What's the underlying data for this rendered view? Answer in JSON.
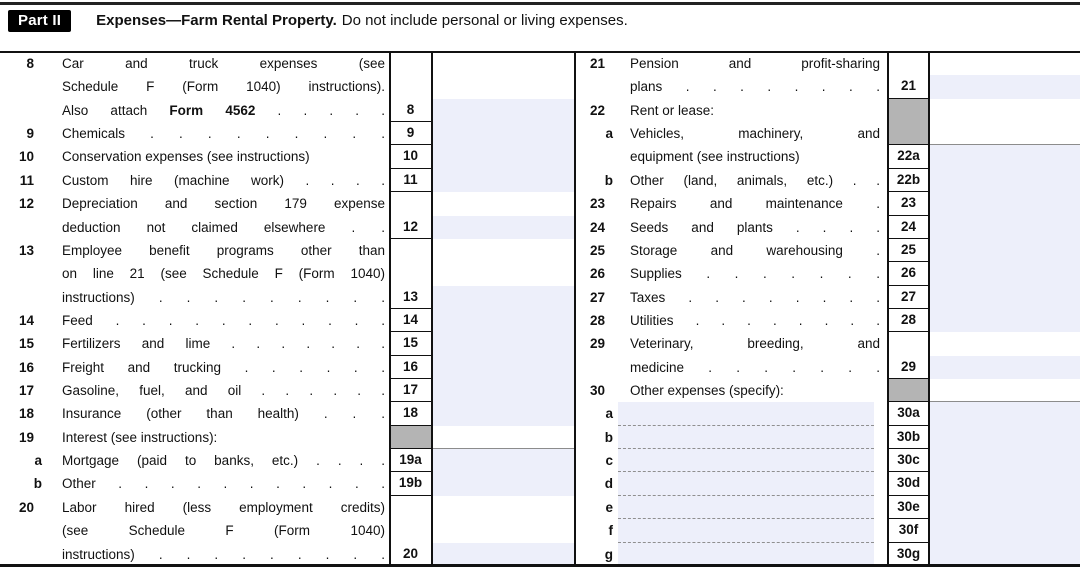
{
  "header": {
    "part_label": "Part II",
    "title": "Expenses—Farm Rental Property.",
    "subtitle": "Do not include personal or living expenses."
  },
  "colors": {
    "field_bg": "#edeffa",
    "shaded_bg": "#b4b4b4",
    "row_line": "#8c8c8c",
    "tag_bg": "#000000"
  },
  "left": {
    "items": [
      {
        "id": "8",
        "prefix": "8",
        "prefix_type": "num",
        "start": 0,
        "lines": [
          {
            "t": "Car and truck expenses (see",
            "j": 1
          },
          {
            "t": "Schedule F (Form 1040) instructions).",
            "j": 1
          },
          {
            "p": [
              {
                "t": "Also attach ",
                "b": 0
              },
              {
                "t": "Form 4562",
                "b": 1
              },
              {
                "t": " . . . . .",
                "b": 0
              }
            ],
            "j": 1
          }
        ]
      },
      {
        "id": "9",
        "prefix": "9",
        "prefix_type": "num",
        "start": 3,
        "lines": [
          {
            "t": "Chemicals . . . . . . . . .",
            "j": 1
          }
        ]
      },
      {
        "id": "10",
        "prefix": "10",
        "prefix_type": "num",
        "start": 4,
        "lines": [
          {
            "t": "Conservation expenses (see instructions)",
            "j": 0
          }
        ]
      },
      {
        "id": "11",
        "prefix": "11",
        "prefix_type": "num",
        "start": 5,
        "lines": [
          {
            "t": "Custom hire (machine work) . . . .",
            "j": 1
          }
        ]
      },
      {
        "id": "12",
        "prefix": "12",
        "prefix_type": "num",
        "start": 6,
        "lines": [
          {
            "t": "Depreciation and section 179 expense",
            "j": 1
          },
          {
            "t": "deduction not claimed elsewhere . .",
            "j": 1
          }
        ]
      },
      {
        "id": "13",
        "prefix": "13",
        "prefix_type": "num",
        "start": 8,
        "lines": [
          {
            "t": "Employee benefit programs other than",
            "j": 1
          },
          {
            "t": "on line 21 (see Schedule F (Form 1040)",
            "j": 1
          },
          {
            "t": "instructions) . . . . . . . . .",
            "j": 1
          }
        ]
      },
      {
        "id": "14",
        "prefix": "14",
        "prefix_type": "num",
        "start": 11,
        "lines": [
          {
            "t": "Feed . . . . . . . . . . .",
            "j": 1
          }
        ]
      },
      {
        "id": "15",
        "prefix": "15",
        "prefix_type": "num",
        "start": 12,
        "lines": [
          {
            "t": "Fertilizers and lime . . . . . . .",
            "j": 1
          }
        ]
      },
      {
        "id": "16",
        "prefix": "16",
        "prefix_type": "num",
        "start": 13,
        "lines": [
          {
            "t": "Freight and trucking . . . . . .",
            "j": 1
          }
        ]
      },
      {
        "id": "17",
        "prefix": "17",
        "prefix_type": "num",
        "start": 14,
        "lines": [
          {
            "t": "Gasoline, fuel, and oil . . . . . .",
            "j": 1
          }
        ]
      },
      {
        "id": "18",
        "prefix": "18",
        "prefix_type": "num",
        "start": 15,
        "lines": [
          {
            "t": "Insurance (other than health) . . .",
            "j": 1
          }
        ]
      },
      {
        "id": "19",
        "prefix": "19",
        "prefix_type": "num",
        "start": 16,
        "lines": [
          {
            "t": "Interest (see instructions):",
            "j": 0
          }
        ]
      },
      {
        "id": "19a",
        "prefix": "a",
        "prefix_type": "letter",
        "start": 17,
        "lines": [
          {
            "t": "Mortgage (paid to banks, etc.) . . . .",
            "j": 1
          }
        ]
      },
      {
        "id": "19b",
        "prefix": "b",
        "prefix_type": "letter",
        "start": 18,
        "lines": [
          {
            "t": "Other . . . . . . . . . . .",
            "j": 1
          }
        ]
      },
      {
        "id": "20",
        "prefix": "20",
        "prefix_type": "num",
        "start": 19,
        "lines": [
          {
            "t": "Labor hired (less employment credits)",
            "j": 1
          },
          {
            "t": "(see Schedule F (Form 1040)",
            "j": 1
          },
          {
            "t": "instructions) . . . . . . . . .",
            "j": 1
          }
        ]
      }
    ],
    "cells": [
      {
        "id": "8",
        "label": "8",
        "start": 0,
        "lines": 3,
        "type": "field"
      },
      {
        "id": "9",
        "label": "9",
        "start": 3,
        "lines": 1,
        "type": "field"
      },
      {
        "id": "10",
        "label": "10",
        "start": 4,
        "lines": 1,
        "type": "field"
      },
      {
        "id": "11",
        "label": "11",
        "start": 5,
        "lines": 1,
        "type": "field"
      },
      {
        "id": "12",
        "label": "12",
        "start": 6,
        "lines": 2,
        "type": "field"
      },
      {
        "id": "13",
        "label": "13",
        "start": 8,
        "lines": 3,
        "type": "field"
      },
      {
        "id": "14",
        "label": "14",
        "start": 11,
        "lines": 1,
        "type": "field"
      },
      {
        "id": "15",
        "label": "15",
        "start": 12,
        "lines": 1,
        "type": "field"
      },
      {
        "id": "16",
        "label": "16",
        "start": 13,
        "lines": 1,
        "type": "field"
      },
      {
        "id": "17",
        "label": "17",
        "start": 14,
        "lines": 1,
        "type": "field"
      },
      {
        "id": "18",
        "label": "18",
        "start": 15,
        "lines": 1,
        "type": "field"
      },
      {
        "id": "19",
        "label": "",
        "start": 16,
        "lines": 1,
        "type": "gray"
      },
      {
        "id": "19a",
        "label": "19a",
        "start": 17,
        "lines": 1,
        "type": "field"
      },
      {
        "id": "19b",
        "label": "19b",
        "start": 18,
        "lines": 1,
        "type": "field"
      },
      {
        "id": "20",
        "label": "20",
        "start": 19,
        "lines": 3,
        "type": "field"
      }
    ]
  },
  "right": {
    "items": [
      {
        "id": "21",
        "prefix": "21",
        "prefix_type": "num",
        "start": 0,
        "lines": [
          {
            "t": "Pension and profit-sharing",
            "j": 1
          },
          {
            "t": "plans . . . . . . . .",
            "j": 1
          }
        ]
      },
      {
        "id": "22",
        "prefix": "22",
        "prefix_type": "num",
        "start": 2,
        "lines": [
          {
            "t": "Rent or lease:",
            "j": 0
          }
        ]
      },
      {
        "id": "22a",
        "prefix": "a",
        "prefix_type": "letter",
        "start": 3,
        "lines": [
          {
            "t": "Vehicles, machinery, and",
            "j": 1
          },
          {
            "t": "equipment (see instructions)",
            "j": 0
          }
        ]
      },
      {
        "id": "22b",
        "prefix": "b",
        "prefix_type": "letter",
        "start": 5,
        "lines": [
          {
            "t": "Other (land, animals, etc.) . .",
            "j": 1
          }
        ]
      },
      {
        "id": "23",
        "prefix": "23",
        "prefix_type": "num",
        "start": 6,
        "lines": [
          {
            "t": "Repairs and maintenance .",
            "j": 1
          }
        ]
      },
      {
        "id": "24",
        "prefix": "24",
        "prefix_type": "num",
        "start": 7,
        "lines": [
          {
            "t": "Seeds and plants . . . .",
            "j": 1
          }
        ]
      },
      {
        "id": "25",
        "prefix": "25",
        "prefix_type": "num",
        "start": 8,
        "lines": [
          {
            "t": "Storage and warehousing .",
            "j": 1
          }
        ]
      },
      {
        "id": "26",
        "prefix": "26",
        "prefix_type": "num",
        "start": 9,
        "lines": [
          {
            "t": "Supplies . . . . . . .",
            "j": 1
          }
        ]
      },
      {
        "id": "27",
        "prefix": "27",
        "prefix_type": "num",
        "start": 10,
        "lines": [
          {
            "t": "Taxes . . . . . . . .",
            "j": 1
          }
        ]
      },
      {
        "id": "28",
        "prefix": "28",
        "prefix_type": "num",
        "start": 11,
        "lines": [
          {
            "t": "Utilities . . . . . . . .",
            "j": 1
          }
        ]
      },
      {
        "id": "29",
        "prefix": "29",
        "prefix_type": "num",
        "start": 12,
        "lines": [
          {
            "t": "Veterinary, breeding, and",
            "j": 1
          },
          {
            "t": "medicine . . . . . . .",
            "j": 1
          }
        ]
      },
      {
        "id": "30",
        "prefix": "30",
        "prefix_type": "num",
        "start": 14,
        "lines": [
          {
            "t": "Other expenses (specify):",
            "j": 0
          }
        ]
      },
      {
        "id": "30a",
        "prefix": "a",
        "prefix_type": "letter",
        "start": 15,
        "writein": true,
        "dash": true
      },
      {
        "id": "30b",
        "prefix": "b",
        "prefix_type": "letter",
        "start": 16,
        "writein": true,
        "dash": true
      },
      {
        "id": "30c",
        "prefix": "c",
        "prefix_type": "letter",
        "start": 17,
        "writein": true,
        "dash": true
      },
      {
        "id": "30d",
        "prefix": "d",
        "prefix_type": "letter",
        "start": 18,
        "writein": true,
        "dash": true
      },
      {
        "id": "30e",
        "prefix": "e",
        "prefix_type": "letter",
        "start": 19,
        "writein": true,
        "dash": true
      },
      {
        "id": "30f",
        "prefix": "f",
        "prefix_type": "letter",
        "start": 20,
        "writein": true,
        "dash": true
      },
      {
        "id": "30g",
        "prefix": "g",
        "prefix_type": "letter",
        "start": 21,
        "writein": true,
        "dash": false
      }
    ],
    "cells": [
      {
        "id": "21",
        "label": "21",
        "start": 0,
        "lines": 2,
        "type": "field"
      },
      {
        "id": "22",
        "label": "",
        "start": 2,
        "lines": 2,
        "type": "gray"
      },
      {
        "id": "22a",
        "label": "22a",
        "start": 4,
        "lines": 1,
        "type": "field"
      },
      {
        "id": "22b",
        "label": "22b",
        "start": 5,
        "lines": 1,
        "type": "field"
      },
      {
        "id": "23",
        "label": "23",
        "start": 6,
        "lines": 1,
        "type": "field"
      },
      {
        "id": "24",
        "label": "24",
        "start": 7,
        "lines": 1,
        "type": "field"
      },
      {
        "id": "25",
        "label": "25",
        "start": 8,
        "lines": 1,
        "type": "field"
      },
      {
        "id": "26",
        "label": "26",
        "start": 9,
        "lines": 1,
        "type": "field"
      },
      {
        "id": "27",
        "label": "27",
        "start": 10,
        "lines": 1,
        "type": "field"
      },
      {
        "id": "28",
        "label": "28",
        "start": 11,
        "lines": 1,
        "type": "field"
      },
      {
        "id": "29",
        "label": "29",
        "start": 12,
        "lines": 2,
        "type": "field"
      },
      {
        "id": "30",
        "label": "",
        "start": 14,
        "lines": 1,
        "type": "gray"
      },
      {
        "id": "30a",
        "label": "30a",
        "start": 15,
        "lines": 1,
        "type": "field"
      },
      {
        "id": "30b",
        "label": "30b",
        "start": 16,
        "lines": 1,
        "type": "field"
      },
      {
        "id": "30c",
        "label": "30c",
        "start": 17,
        "lines": 1,
        "type": "field"
      },
      {
        "id": "30d",
        "label": "30d",
        "start": 18,
        "lines": 1,
        "type": "field"
      },
      {
        "id": "30e",
        "label": "30e",
        "start": 19,
        "lines": 1,
        "type": "field"
      },
      {
        "id": "30f",
        "label": "30f",
        "start": 20,
        "lines": 1,
        "type": "field"
      },
      {
        "id": "30g",
        "label": "30g",
        "start": 21,
        "lines": 1,
        "type": "field"
      }
    ]
  }
}
